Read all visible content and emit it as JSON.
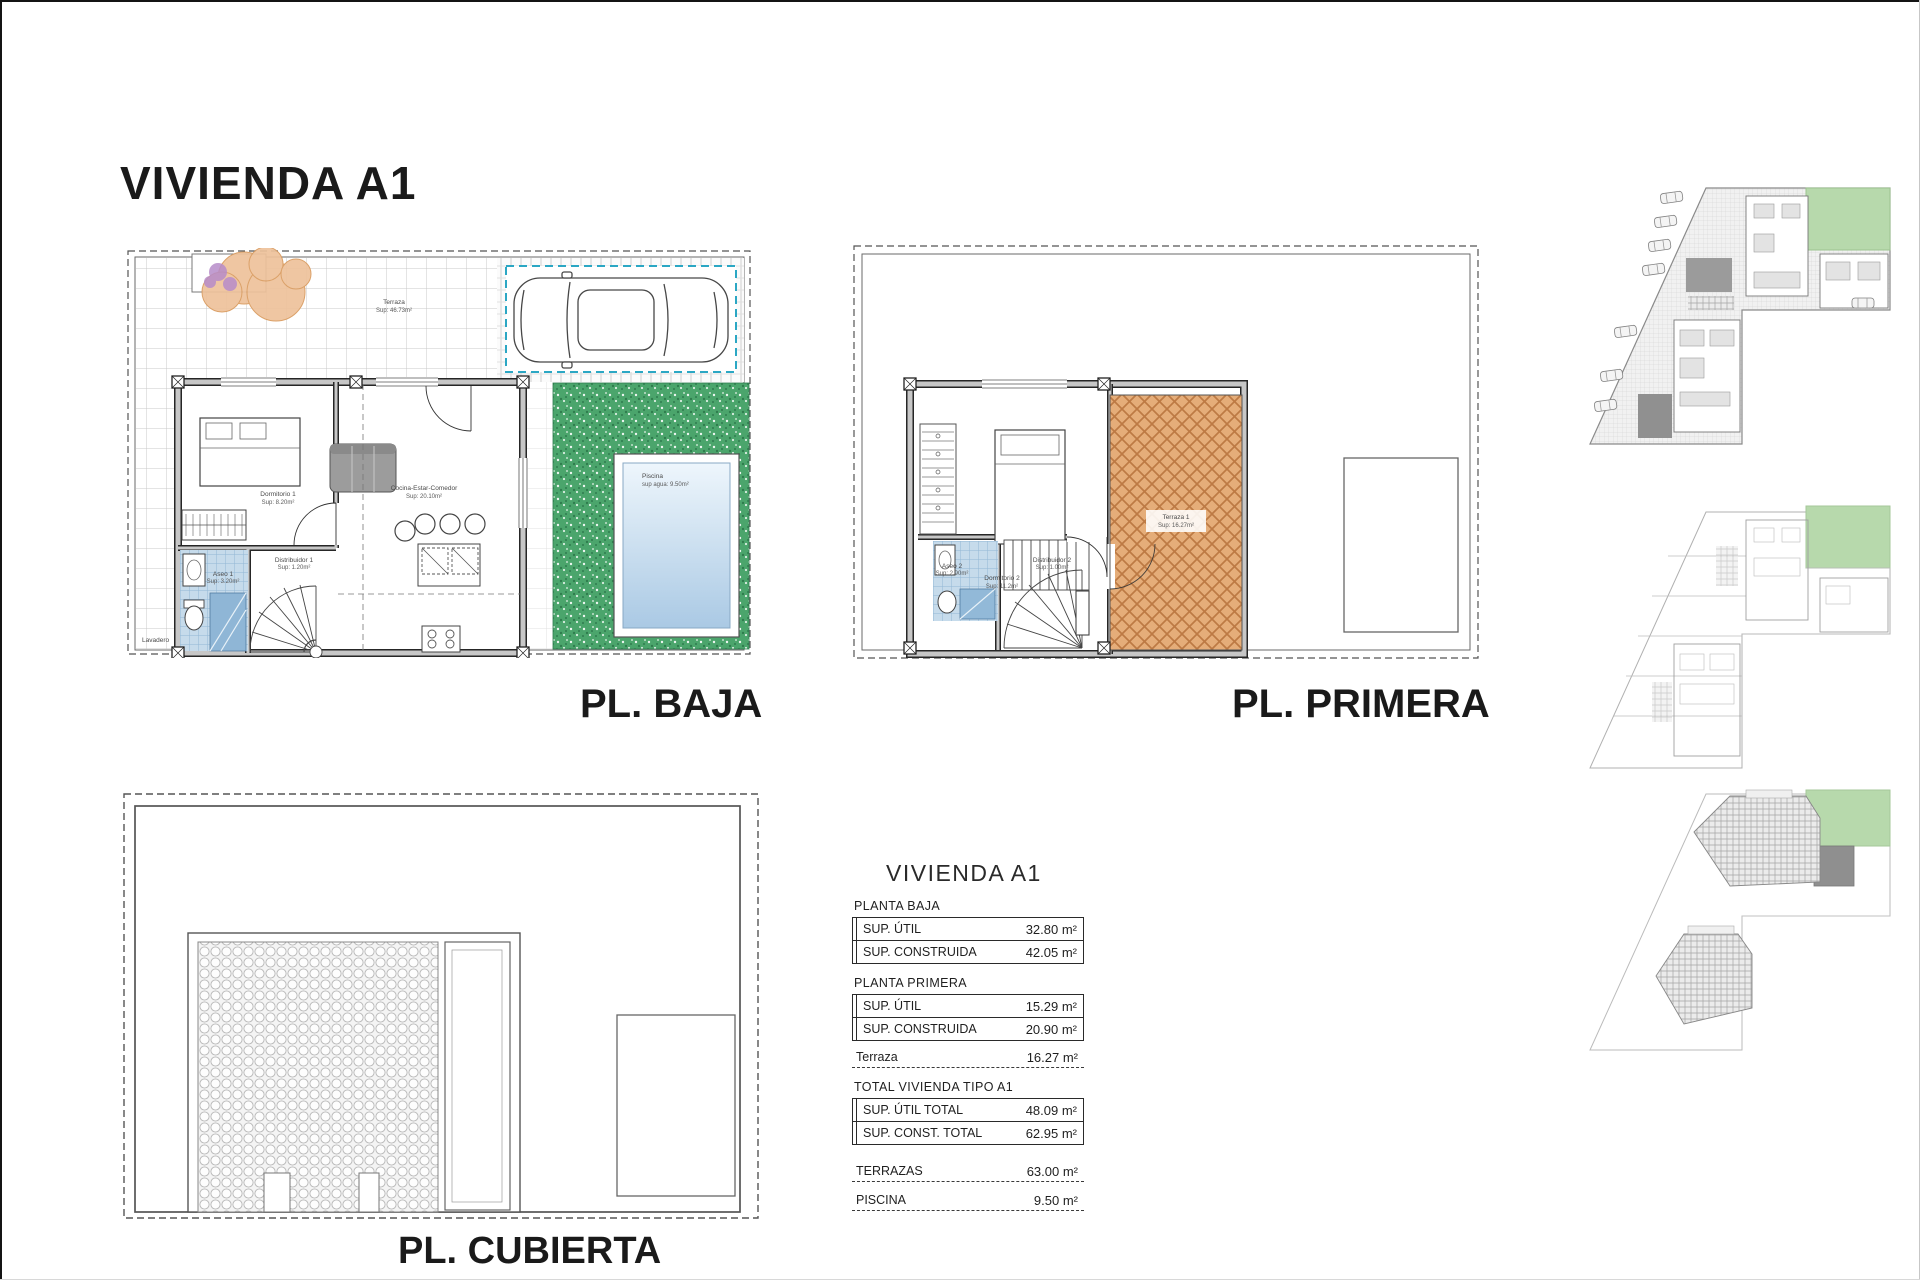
{
  "page": {
    "title": "VIVIENDA A1",
    "watermark": "SH"
  },
  "floor_labels": {
    "baja": "PL. BAJA",
    "primera": "PL. PRIMERA",
    "cubierta": "PL. CUBIERTA"
  },
  "plan_baja": {
    "terraza_label": "Terraza",
    "terraza_sup": "Sup: 46.73m²",
    "dormitorio_label": "Dormitorio 1",
    "dormitorio_sup": "Sup: 8.20m²",
    "cocina_label": "Cocina-Estar-Comedor",
    "cocina_sup": "Sup: 20.10m²",
    "aseo_label": "Aseo 1",
    "aseo_sup": "Sup: 3.20m²",
    "distribuidor_label": "Distribuidor 1",
    "distribuidor_sup": "Sup: 1.20m²",
    "lavadero_label": "Lavadero",
    "piscina_label": "Piscina",
    "piscina_sup": "sup agua: 9.50m²"
  },
  "plan_primera": {
    "dormitorio_label": "Dormitorio 2",
    "dormitorio_sup": "Sup: 11.2m²",
    "aseo_label": "Aseo 2",
    "aseo_sup": "Sup: 2.90m²",
    "distribuidor_label": "Distribuidor 2",
    "distribuidor_sup": "Sup: 1.00m²",
    "terraza_label": "Terraza 1",
    "terraza_sup": "Sup: 16.27m²"
  },
  "summary": {
    "title": "VIVIENDA A1",
    "planta_baja_heading": "PLANTA BAJA",
    "pb_rows": [
      {
        "label": "SUP. ÚTIL",
        "value": "32.80 m²"
      },
      {
        "label": "SUP. CONSTRUIDA",
        "value": "42.05 m²"
      }
    ],
    "planta_primera_heading": "PLANTA PRIMERA",
    "pp_rows": [
      {
        "label": "SUP. ÚTIL",
        "value": "15.29 m²"
      },
      {
        "label": "SUP. CONSTRUIDA",
        "value": "20.90 m²"
      }
    ],
    "terraza_row": {
      "label": "Terraza",
      "value": "16.27 m²"
    },
    "total_heading": "TOTAL VIVIENDA TIPO A1",
    "total_rows": [
      {
        "label": "SUP. ÚTIL TOTAL",
        "value": "48.09 m²"
      },
      {
        "label": "SUP. CONST. TOTAL",
        "value": "62.95 m²"
      }
    ],
    "extra_rows": [
      {
        "label": "TERRAZAS",
        "value": "63.00 m²"
      },
      {
        "label": "PISCINA",
        "value": "9.50 m²"
      }
    ]
  },
  "colors": {
    "highlight_green": "#b7d9ac",
    "terrace_orange": "#e5ad79",
    "grass_green": "#4ba56c",
    "pool_blue": "#aac9e4",
    "bath_tile_blue": "#c6dbeb",
    "parking_dash_teal": "#2ba7c4"
  }
}
